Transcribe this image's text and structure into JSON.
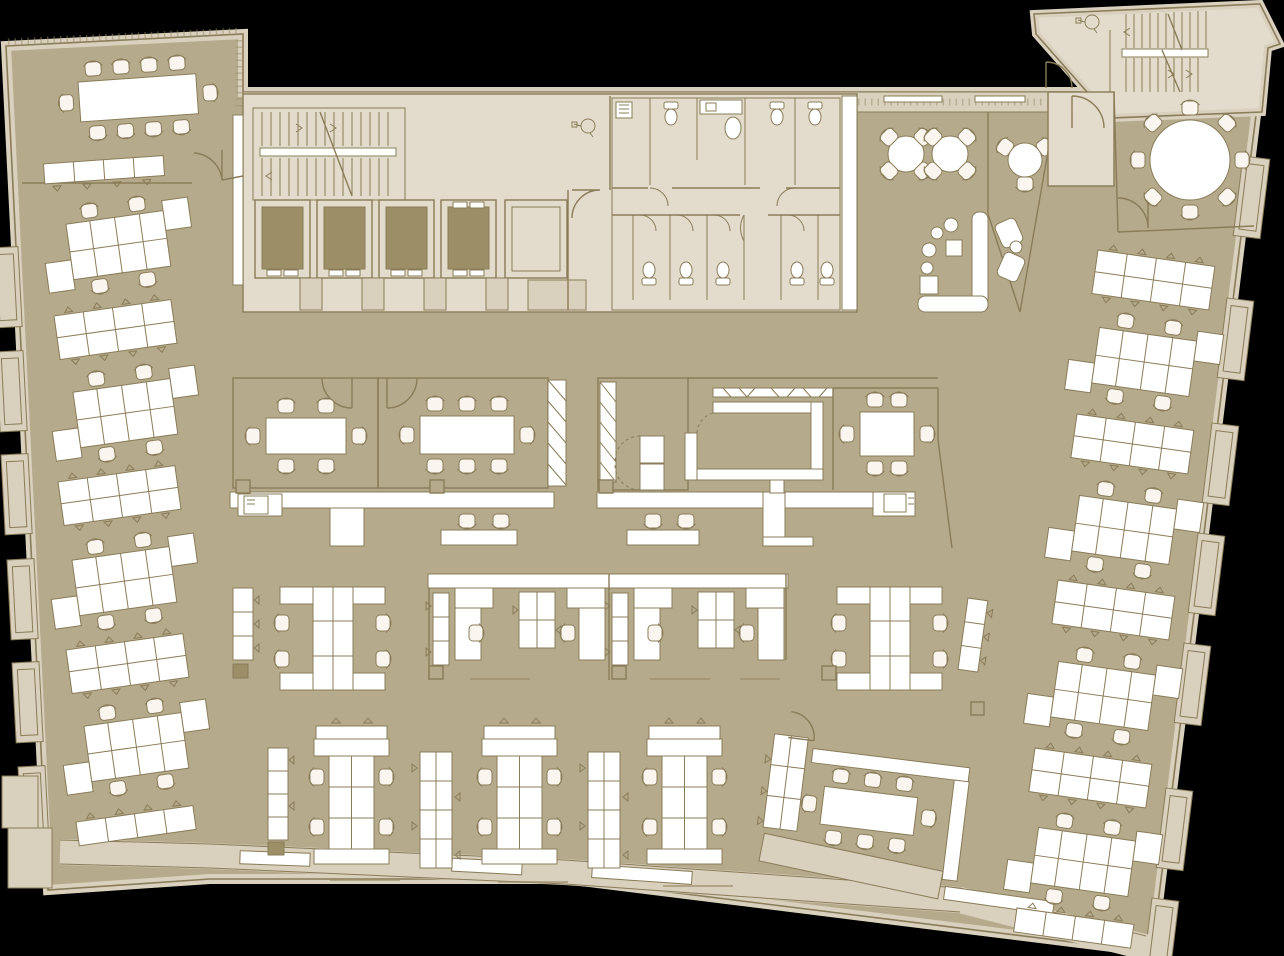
{
  "canvas": {
    "width": 1284,
    "height": 956
  },
  "palette": {
    "background": "#000000",
    "floor": "#b5aa8c",
    "core": "#e3dccd",
    "wall_fill": "#d9d0be",
    "line": "#8a7c58",
    "line_soft": "#9c8e6a",
    "shaft": "#9c8e66",
    "furniture": "#ffffff",
    "chair": "#faf6ef",
    "band": "#ffffff"
  },
  "legend": {
    "drawing_type": "office-floor-plan",
    "rooms": [
      {
        "name": "northwest-conference-room",
        "seats": 10
      },
      {
        "name": "center-left-meeting-room",
        "seats": 6
      },
      {
        "name": "center-meeting-room",
        "seats": 8
      },
      {
        "name": "center-right-meeting-room",
        "seats": 6
      },
      {
        "name": "northeast-round-conference-room",
        "seats": 8
      },
      {
        "name": "southeast-conference-room",
        "seats": 8
      },
      {
        "name": "cafe-lounge",
        "seats": 13
      },
      {
        "name": "restrooms",
        "stalls": 9
      },
      {
        "name": "storage-room",
        "cabinets": 2
      }
    ],
    "circulation": {
      "elevators": 4,
      "stairwells": 2,
      "vestibules": 2
    },
    "workstations": {
      "left-wing-desk-rows": 4,
      "right-wing-desk-rows": 4,
      "seats-per-desk-row": 4,
      "bottom-desk-pods": 3,
      "center-desk-pods": 2,
      "seats-per-pod": 4,
      "focus-booth-desks": 4,
      "touchdown-stools": 4,
      "layout-table-rows": 9
    }
  }
}
